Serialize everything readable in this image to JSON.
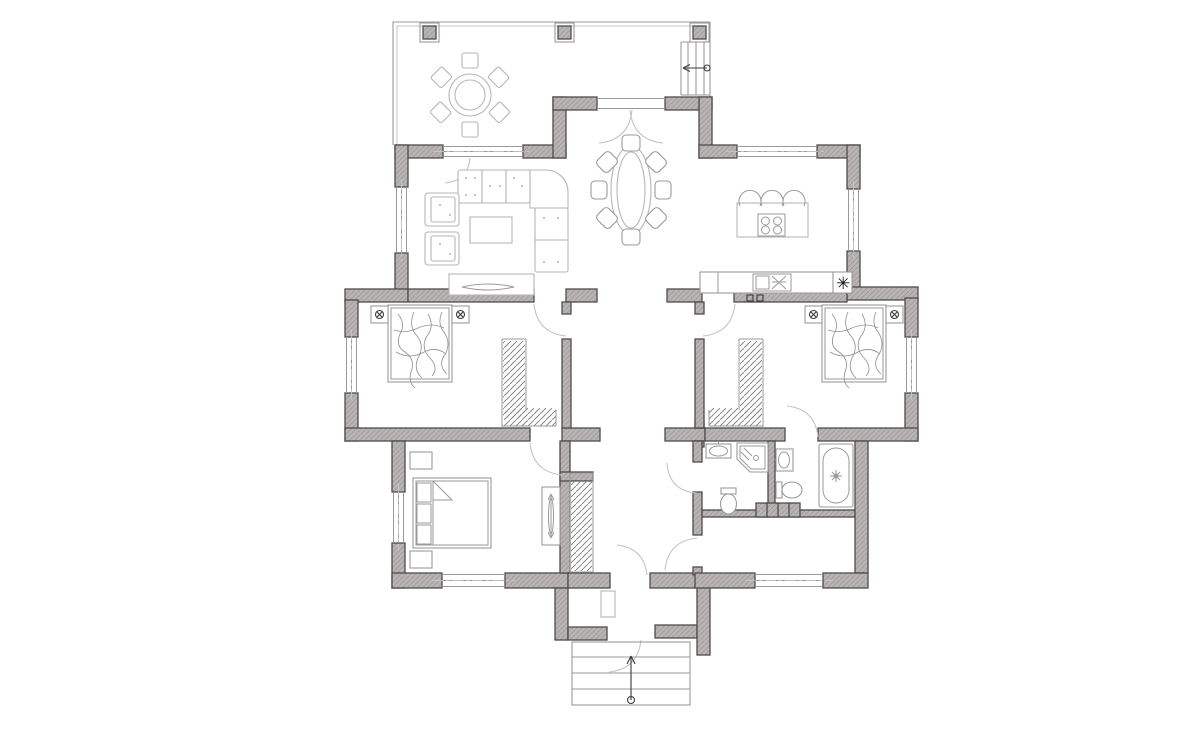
{
  "page": {
    "background": "#ffffff",
    "drawing_kind": "floor-plan"
  },
  "colors": {
    "background": "#ffffff",
    "wall_fill": "#b9b5b5",
    "wall_hatch": "#a49e9e",
    "wall_stroke": "#4f4c4c",
    "furniture_line": "#b6b6b6",
    "fixture_line": "#9a9a9a",
    "sketch_line": "#8f8f8f",
    "door_line": "#c3c3c3",
    "window_line": "#9a9a9a",
    "dark": "#3a3a3a"
  },
  "symbols": {
    "boiler": "✳"
  },
  "plan": {
    "aria_label": "house ground floor plan",
    "rooms": [
      {
        "id": "terrace",
        "items": [
          "round-table",
          "chair x6",
          "column x3",
          "side-steps",
          "stair-arrow"
        ]
      },
      {
        "id": "living-room",
        "items": [
          "corner-sofa",
          "armchair x2",
          "coffee-table",
          "tv-stand",
          "tv"
        ]
      },
      {
        "id": "dining-room",
        "items": [
          "oval-table",
          "chair x8",
          "french-doors"
        ]
      },
      {
        "id": "kitchen",
        "items": [
          "island-with-cooktop",
          "bar-stool x3",
          "counter",
          "sink-unit",
          "boiler-symbol",
          "wall-vent x2"
        ]
      },
      {
        "id": "bedroom-left",
        "items": [
          "double-bed",
          "nightstand-with-lamp x2",
          "walk-in-closet",
          "door"
        ]
      },
      {
        "id": "bedroom-right",
        "items": [
          "double-bed",
          "nightstand-with-lamp x2",
          "walk-in-closet",
          "door",
          "ensuite-door"
        ]
      },
      {
        "id": "bedroom-lower",
        "items": [
          "double-bed",
          "nightstand x2",
          "dresser-with-mirror",
          "closet",
          "door"
        ]
      },
      {
        "id": "shower-room",
        "items": [
          "washbasin",
          "corner-shower",
          "toilet",
          "door"
        ]
      },
      {
        "id": "bathroom",
        "items": [
          "washbasin",
          "toilet",
          "bathtub",
          "radiator"
        ]
      },
      {
        "id": "utility-hall",
        "items": [
          "door",
          "window"
        ]
      },
      {
        "id": "hallway",
        "items": []
      },
      {
        "id": "vestibule",
        "items": [
          "entrance-door",
          "front-steps",
          "entry-arrow"
        ]
      }
    ],
    "windows_count": 10,
    "doors_count": 11
  }
}
